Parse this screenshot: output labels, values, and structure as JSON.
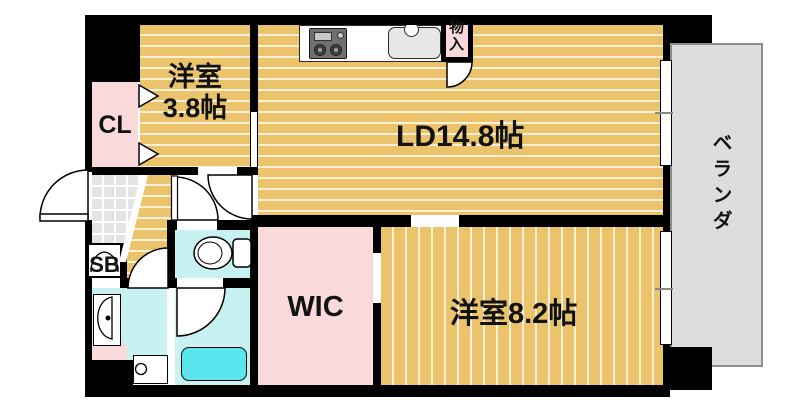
{
  "floorplan": {
    "rooms": {
      "living_dining": "LD14.8帖",
      "western_room_small_line1": "洋室",
      "western_room_small_line2": "3.8帖",
      "western_room_large": "洋室8.2帖",
      "walk_in_closet": "WIC",
      "closet": "CL",
      "shoe_box": "SB",
      "storage": "物入",
      "veranda": "ベランダ"
    },
    "fixtures": {
      "stove": "gas-stove",
      "sink": "kitchen-sink",
      "toilet": "toilet",
      "bathtub": "bathtub",
      "washbasin": "washbasin",
      "washing_machine": "washing-machine-space"
    },
    "colors": {
      "wall": "#000000",
      "wood_floor": "#EAC36B",
      "closet_pink": "#FAD9DB",
      "wet_area_cyan": "#C7F2F1",
      "bathtub_cyan": "#5BE6EF",
      "entry_tile": "#E4E4E4",
      "veranda_gray": "#DDDDDD"
    }
  }
}
